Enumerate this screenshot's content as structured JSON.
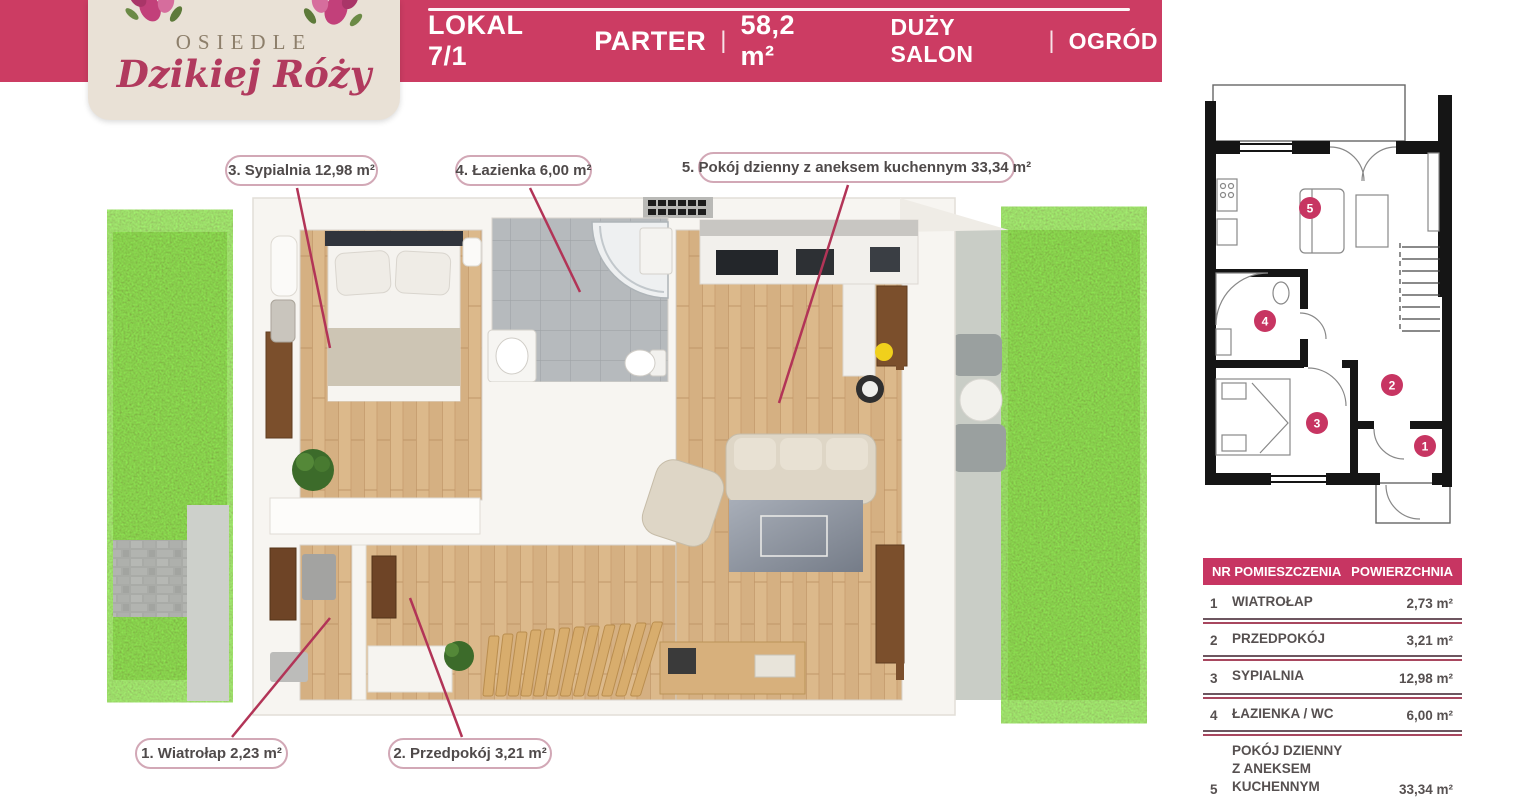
{
  "brand": {
    "estate_label": "OSIEDLE",
    "estate_name": "Dzikiej Róży"
  },
  "header": {
    "unit_label": "LOKAL 7/1",
    "floor": "PARTER",
    "separator": "|",
    "area": "58,2 m²",
    "feature1": "DUŻY SALON",
    "feature2": "OGRÓD"
  },
  "plan_labels": [
    {
      "id": "1",
      "text": "1.  Wiatrołap  2,23 m²"
    },
    {
      "id": "2",
      "text": "2.  Przedpokój  3,21 m²"
    },
    {
      "id": "3",
      "text": "3.  Sypialnia  12,98 m²"
    },
    {
      "id": "4",
      "text": "4.  Łazienka  6,00 m²"
    },
    {
      "id": "5",
      "text": "5.  Pokój dzienny z aneksem kuchennym  33,34 m²"
    }
  ],
  "mini_plan": {
    "room_numbers": [
      "1",
      "2",
      "3",
      "4",
      "5"
    ]
  },
  "table": {
    "header": {
      "col1": "NR POMIESZCZENIA",
      "col2": "POWIERZCHNIA"
    },
    "rows": [
      {
        "nr": "1",
        "name": "WIATROŁAP",
        "name2": "",
        "area": "2,73 m²"
      },
      {
        "nr": "2",
        "name": "PRZEDPOKÓJ",
        "name2": "",
        "area": "3,21 m²"
      },
      {
        "nr": "3",
        "name": "SYPIALNIA",
        "name2": "",
        "area": "12,98 m²"
      },
      {
        "nr": "4",
        "name": "ŁAZIENKA / WC",
        "name2": "",
        "area": "6,00 m²"
      },
      {
        "nr": "5",
        "name": "POKÓJ DZIENNY",
        "name2": "Z ANEKSEM KUCHENNYM",
        "area": "33,34 m²"
      }
    ],
    "total": {
      "label": "ŁĄCZNIE",
      "area": "58,27 m²"
    }
  },
  "colors": {
    "header_bar": "#cc3c63",
    "table_accent": "#c73562",
    "leader_line": "#b23457",
    "logo_card": "#e9e1d6",
    "logo_script": "#b13a5e",
    "grass": "#6fa238",
    "wood_floor": "#dcb98b"
  }
}
